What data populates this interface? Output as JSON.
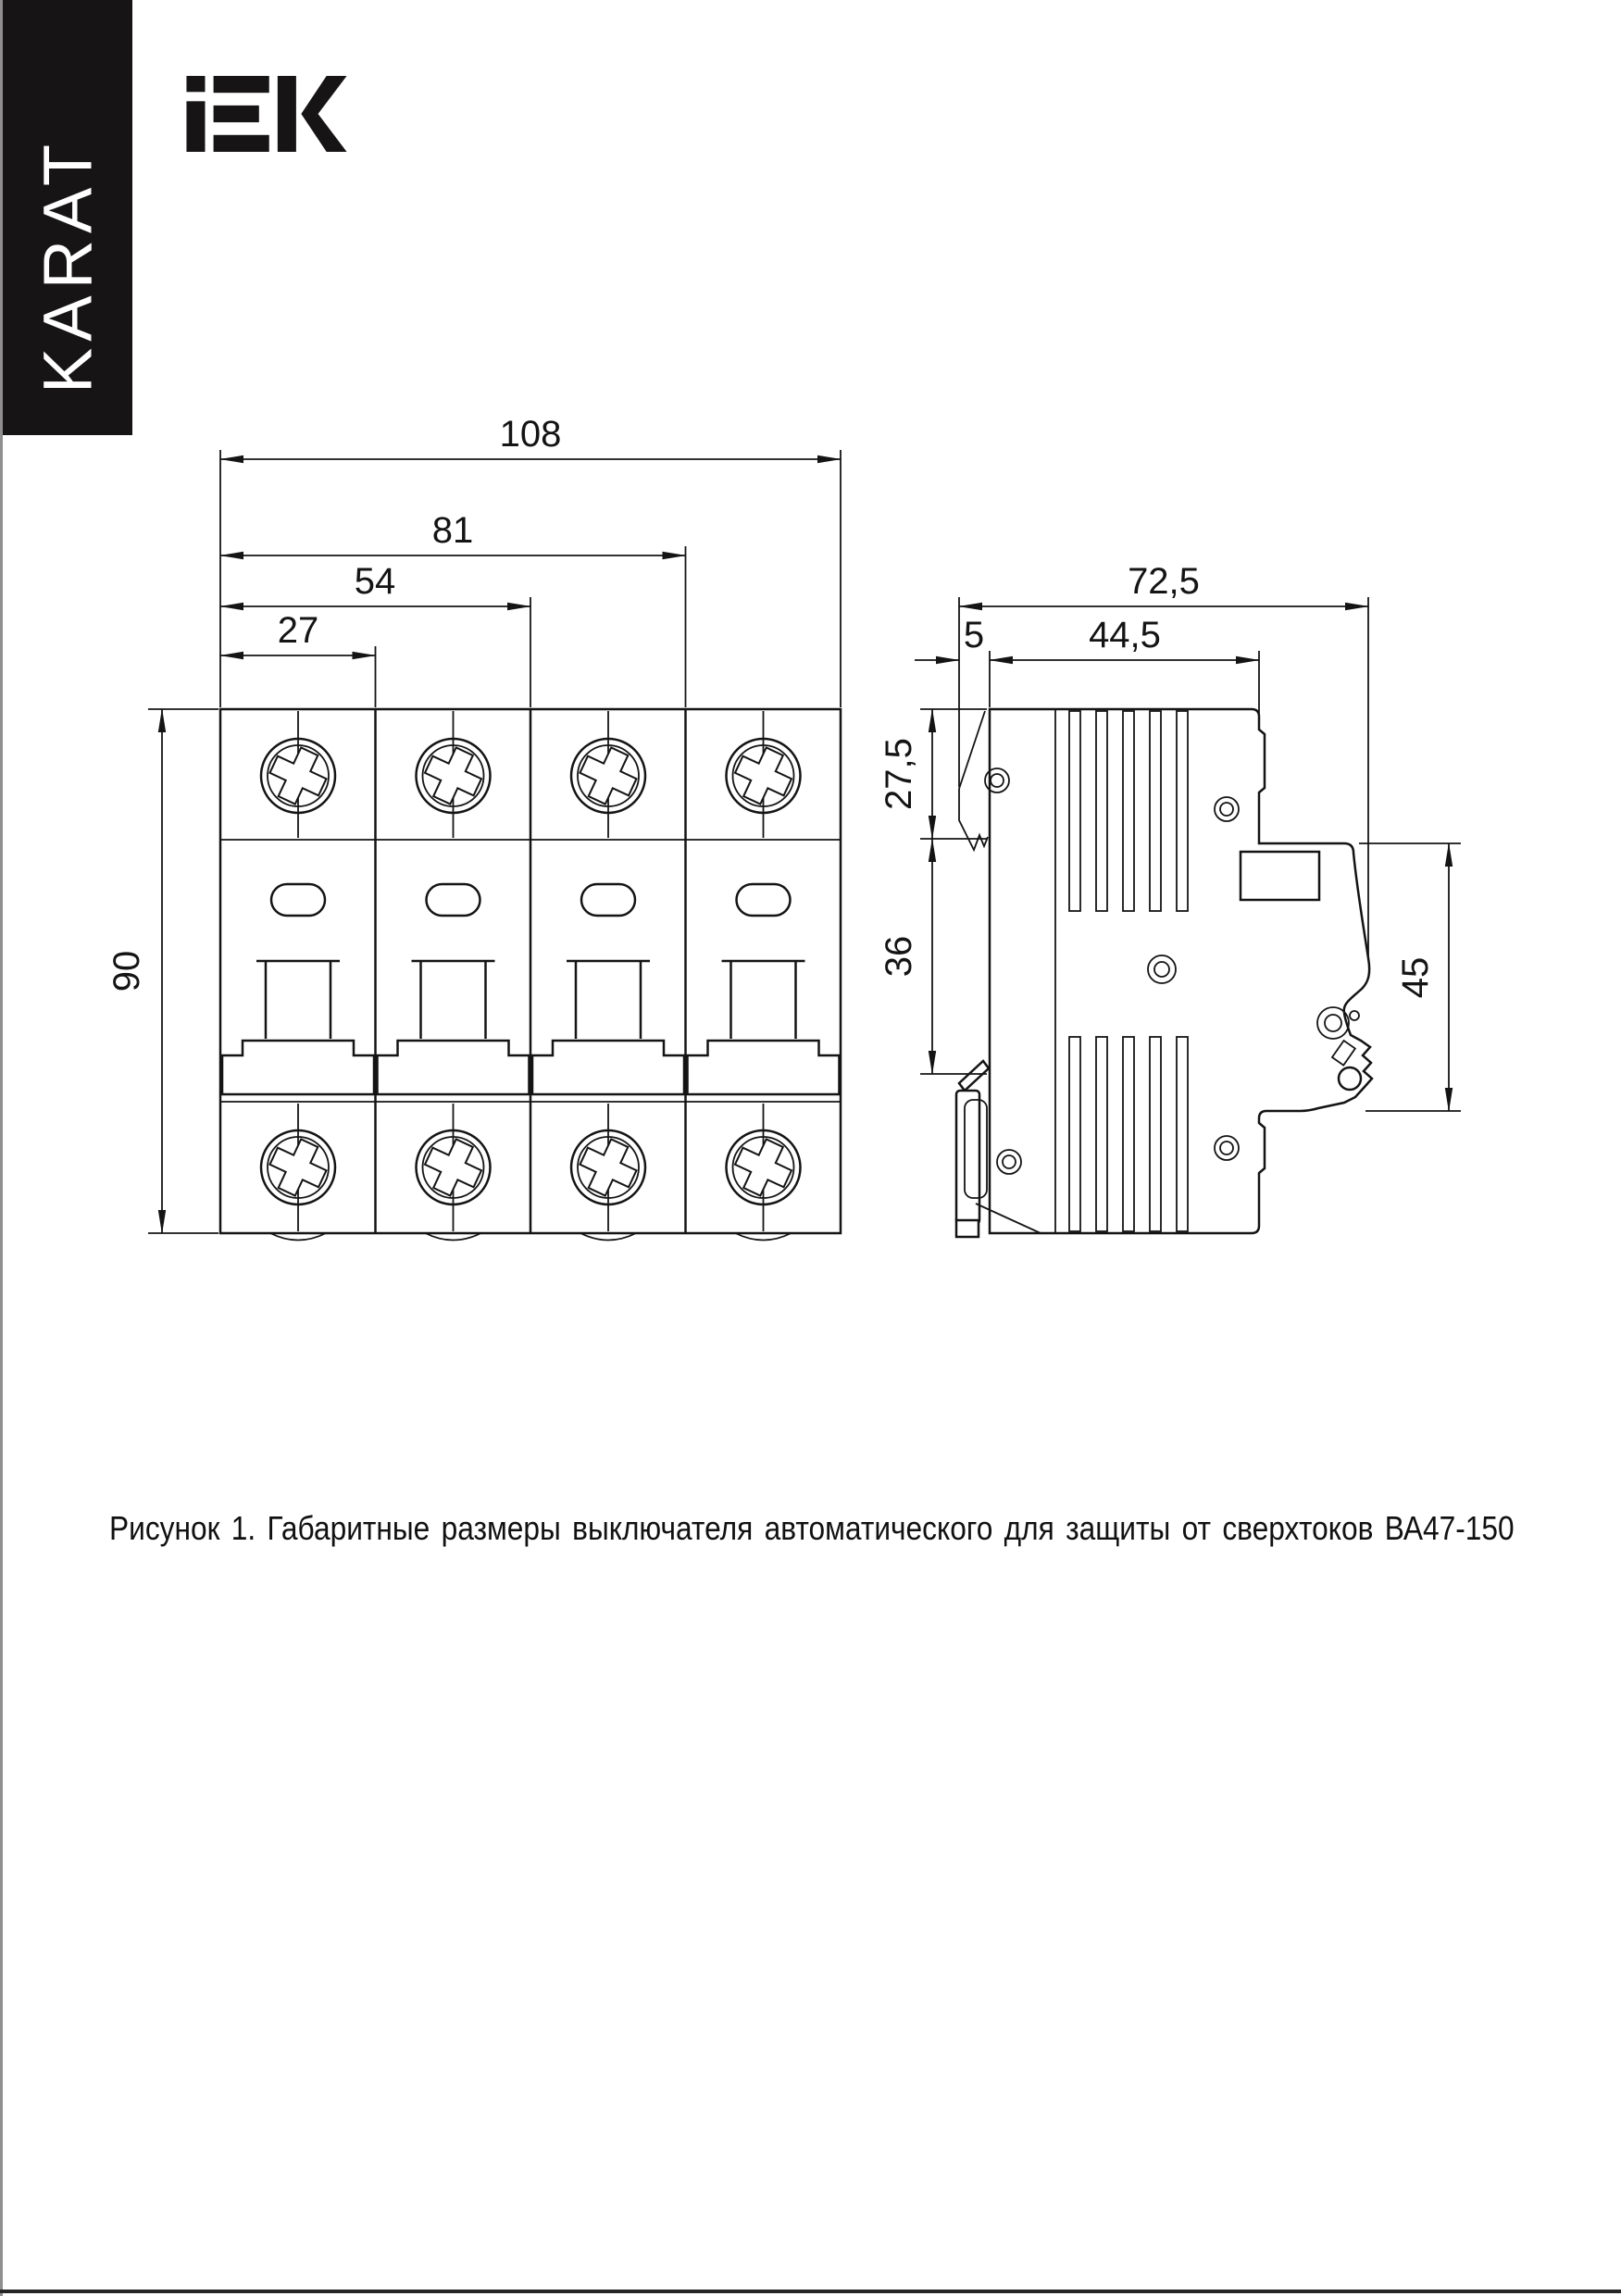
{
  "page": {
    "caption": "Рисунок 1. Габаритные размеры выключателя автоматического для защиты от сверхтоков ВА47-150"
  },
  "brand": {
    "sidebar_text": "KARAT",
    "logo_text": "IEK"
  },
  "front_view": {
    "dims": {
      "total_width": "108",
      "width_81": "81",
      "width_54": "54",
      "width_27": "27",
      "height": "90"
    }
  },
  "side_view": {
    "dims": {
      "total_depth": "72,5",
      "hook_depth": "5",
      "body_depth": "44,5",
      "top_to_rail": "27,5",
      "rail_section": "36",
      "front_height": "45"
    }
  }
}
